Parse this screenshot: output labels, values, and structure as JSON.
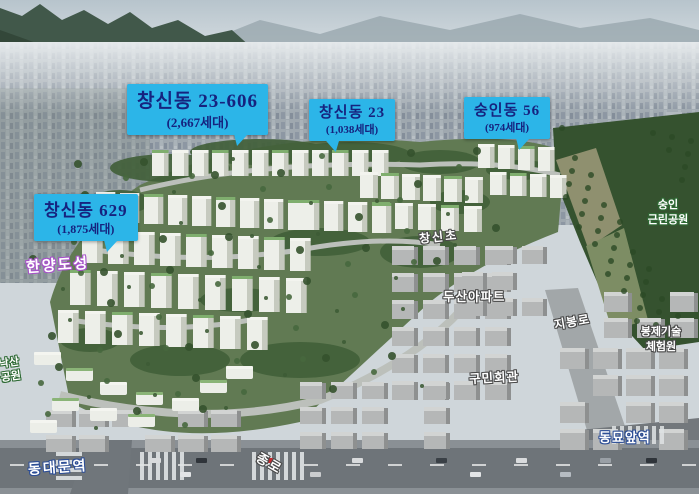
{
  "callouts": [
    {
      "name": "changsin-23-606",
      "title": "창신동 23-606",
      "subtitle": "(2,667세대)"
    },
    {
      "name": "changsin-23",
      "title": "창신동 23",
      "subtitle": "(1,038세대)"
    },
    {
      "name": "sungin-56",
      "title": "숭인동 56",
      "subtitle": "(974세대)"
    },
    {
      "name": "changsin-629",
      "title": "창신동 629",
      "subtitle": "(1,875세대)"
    }
  ],
  "place_labels": {
    "hanyang_fortress": {
      "text": "한양도성"
    },
    "changsin_elementary": {
      "text": "창신초"
    },
    "doosan_apartment": {
      "text": "두산아파트"
    },
    "jibong_ro": {
      "text": "지봉로"
    },
    "sungin_park": {
      "line1": "숭인",
      "line2": "근린공원"
    },
    "sewing_center": {
      "line1": "봉제기술",
      "line2": "체험원"
    },
    "gumin_hall": {
      "text": "구민회관"
    },
    "dongmyo_station": {
      "text": "동묘앞역"
    },
    "dongdaemun_station": {
      "text": "동대문역"
    },
    "jongno": {
      "text": "종로"
    },
    "naksan_park": {
      "line1": "낙산",
      "line2": "공원"
    }
  },
  "colors": {
    "callout_bg": "#2cb5e8",
    "callout_text": "#16237f",
    "outline_purple": "#a653c8",
    "outline_green": "#2f6b35",
    "outline_navy": "#2d4e96",
    "outline_dark": "#4a4a4a"
  }
}
